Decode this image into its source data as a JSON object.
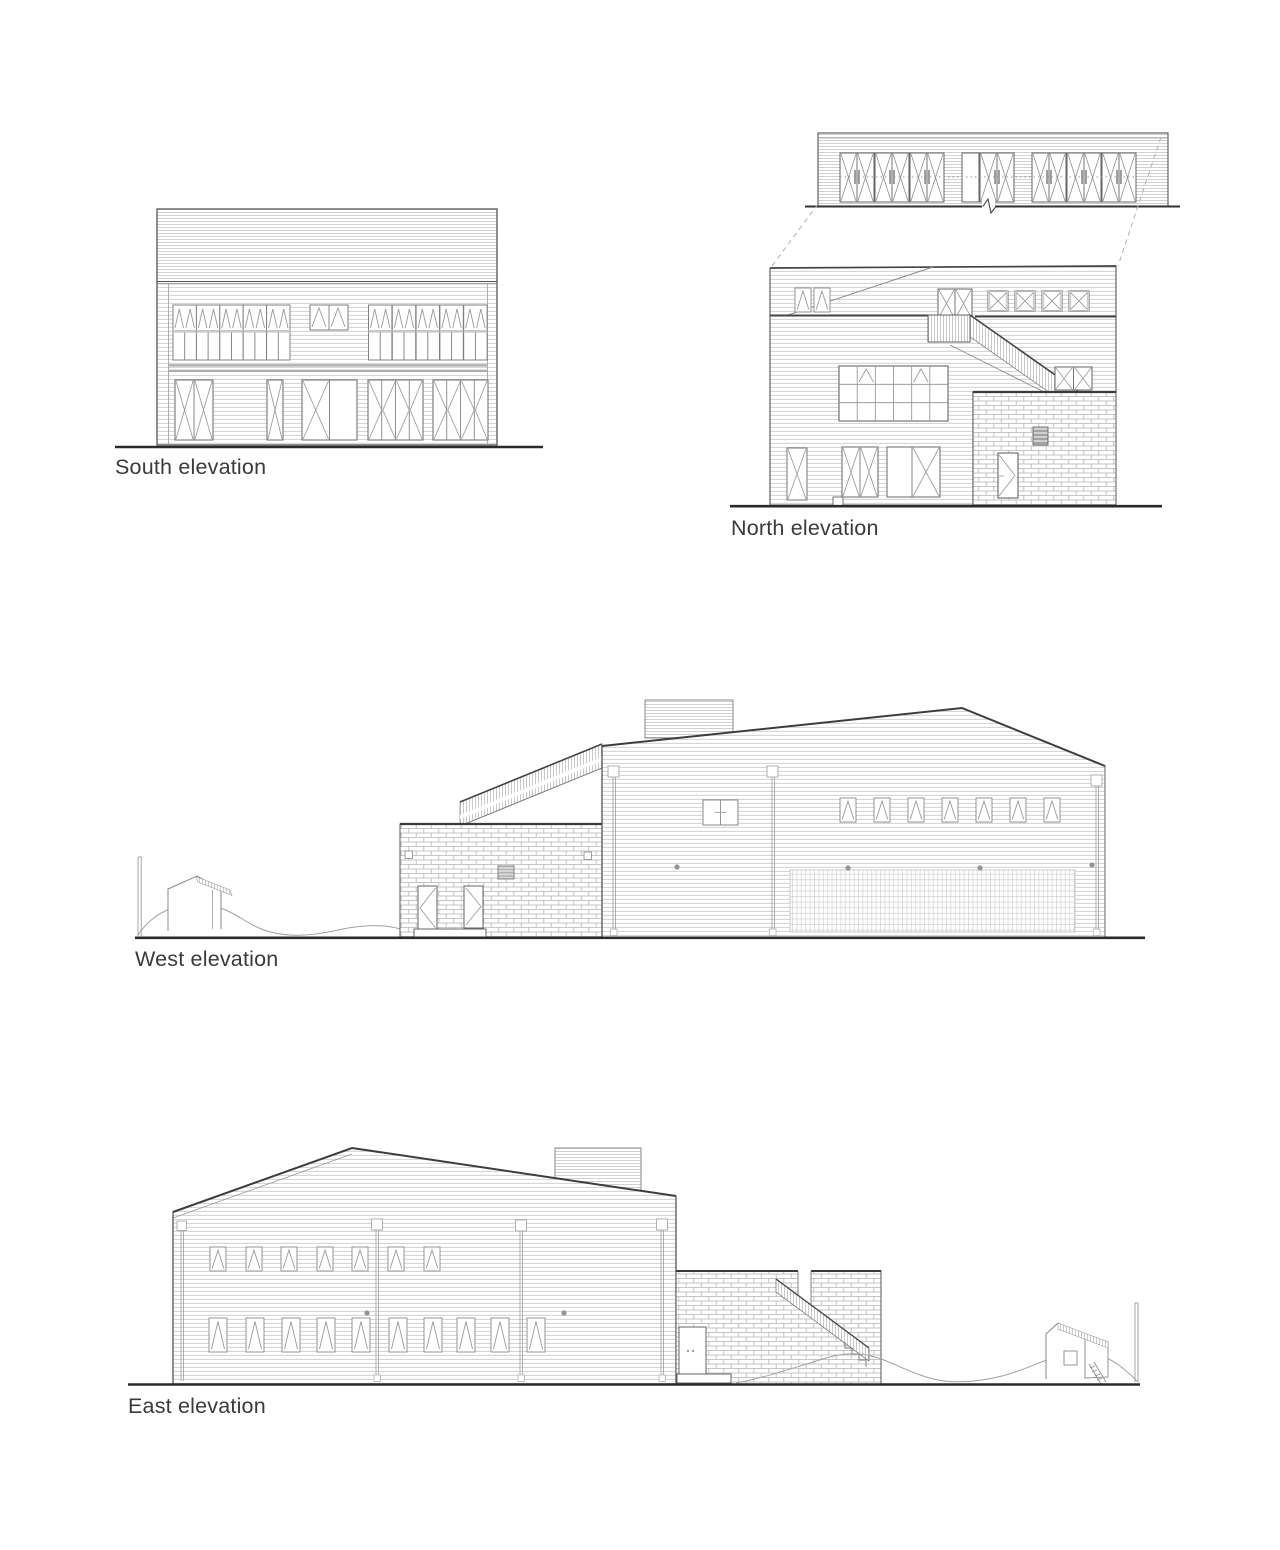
{
  "drawing": {
    "type": "architectural-elevation-sheet",
    "labels": {
      "south": "South elevation",
      "north": "North elevation",
      "west": "West elevation",
      "east": "East elevation"
    },
    "colors": {
      "background": "#ffffff",
      "outline": "#555555",
      "heavy_edge": "#3d3d3d",
      "siding_line": "#c6c6c6",
      "brick_line": "#b4b4b4",
      "hatch_line": "#a5a5a5",
      "glyph_line": "#999999",
      "ground_line": "#2a2a2a",
      "label_text": "#3a3a3a"
    }
  }
}
